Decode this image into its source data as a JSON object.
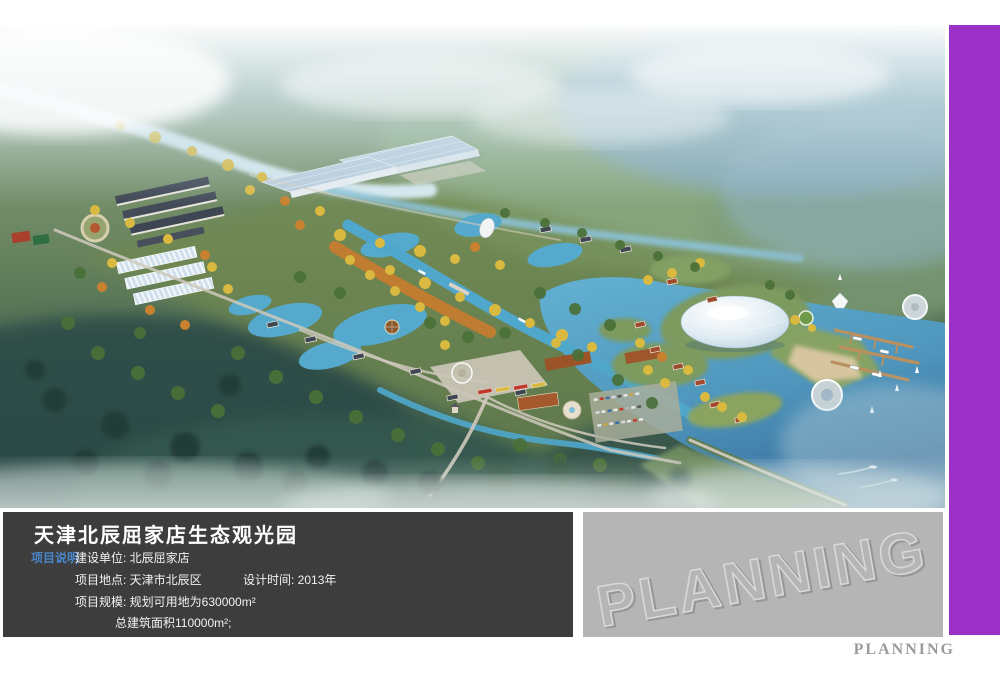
{
  "info_panel": {
    "title": "天津北辰屈家店生态观光园",
    "tag": "项目说明",
    "rows": [
      "建设单位: 北辰屈家店",
      "项目地点: 天津市北辰区",
      "设计时间: 2013年",
      "项目规模: 规划可用地为630000m²",
      "总建筑面积110000m²;"
    ]
  },
  "watermark": {
    "text": "PLANNING"
  },
  "footer": {
    "brand": "PLANNING"
  },
  "colors": {
    "accent_bar": "#9c31c7",
    "panel_background": "#3d3d3d",
    "panel_tag_text": "#4a86c8",
    "watermark_box": "#b5b5b5",
    "footer_text": "#9b9b9b"
  }
}
